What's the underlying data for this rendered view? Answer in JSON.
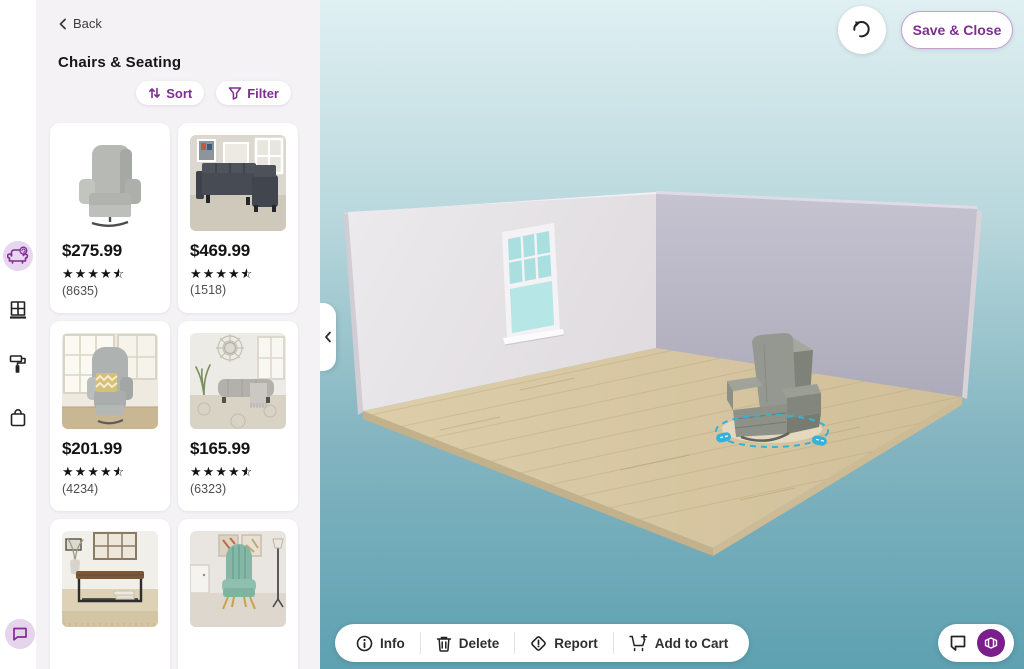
{
  "colors": {
    "accent_purple": "#7f2d91",
    "selection_teal": "#35b2da",
    "background_top": "#e0f0f2",
    "background_bottom": "#5ea1b1",
    "left_wall": "#e8e4e8",
    "right_wall": "#bcb9c8",
    "floor_wood": "#d8c7a3"
  },
  "rail": {
    "items": [
      {
        "icon": "armchair-furniture-icon",
        "active": true
      },
      {
        "icon": "window-icon",
        "active": false
      },
      {
        "icon": "paint-roller-icon",
        "active": false
      },
      {
        "icon": "shopping-bag-icon",
        "active": false
      }
    ],
    "feedback_icon": "chat-bubble-icon"
  },
  "panel": {
    "back_label": "Back",
    "title": "Chairs & Seating",
    "sort_label": "Sort",
    "filter_label": "Filter",
    "products": [
      {
        "price": "$275.99",
        "rating": 4.5,
        "review_count": "(8635)",
        "image": "gray-swivel-recliner"
      },
      {
        "price": "$469.99",
        "rating": 4.5,
        "review_count": "(1518)",
        "image": "dark-gray-sectional-sofa"
      },
      {
        "price": "$201.99",
        "rating": 4.5,
        "review_count": "(4234)",
        "image": "gray-wingback-recliner"
      },
      {
        "price": "$165.99",
        "rating": 4.5,
        "review_count": "(6323)",
        "image": "gray-storage-ottoman-bench"
      },
      {
        "image": "wood-metal-console-bench"
      },
      {
        "image": "teal-velvet-accent-chair"
      }
    ]
  },
  "canvas": {
    "undo_icon": "rotate-counterclockwise-icon",
    "save_close_label": "Save & Close",
    "toolbar": {
      "info_label": "Info",
      "delete_label": "Delete",
      "report_label": "Report",
      "add_to_cart_label": "Add to Cart"
    },
    "corner_icons": {
      "note_icon": "comment-note-icon",
      "view_icon": "room-3d-view-icon"
    },
    "scene": {
      "placed_item": "gray-recliner-chair",
      "window": "double-hung-window",
      "selection_indicator": "dashed-teal-ellipse"
    }
  }
}
